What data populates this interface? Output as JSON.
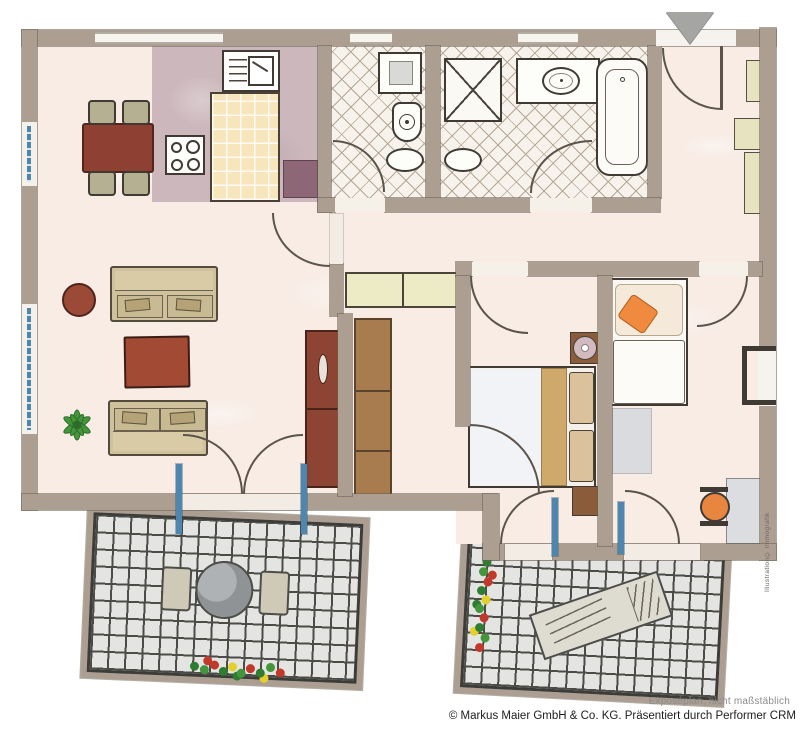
{
  "footer": {
    "disclaimer": "Exposéplan, nicht maßstäblich",
    "copyright": "© Markus Maier GmbH & Co. KG. Präsentiert durch Performer CRM"
  },
  "watermark": "Illustration© immografik",
  "plan": {
    "type": "apartment-floorplan",
    "rooms": [
      "kitchen-dining",
      "living-room",
      "guest-bathroom",
      "bathroom",
      "hallway",
      "entrance",
      "bedroom",
      "kids-room",
      "balcony-left",
      "balcony-right"
    ],
    "entrance_marker": "triangle-down"
  },
  "colors": {
    "wall": "#ac9f91",
    "floor": "#f8ece5",
    "kitchen_floor": "#ccb8bc",
    "tile_bg": "#f7f3ec",
    "tile_line": "#b3a694",
    "island": "#f7e5bb",
    "fridge": "#8d6775",
    "table_red": "#8e4133",
    "chair_olive": "#b6b093",
    "sofa_tan": "#cfc19b",
    "coffee_red": "#a34a35",
    "cabinet_red": "#8e4433",
    "wardrobe_brown": "#a87c4e",
    "shelf_beige": "#ecebc6",
    "bed_white": "#f1f3f6",
    "runner_tan": "#cfa96b",
    "pillow_tan": "#dbc29c",
    "nightstand_brown": "#8a5c3a",
    "kids_pillow": "#ef8a3e",
    "rug_gray": "#d9dbde",
    "desk_gray": "#dbdde0",
    "chair_orange": "#e8853f",
    "balcony_tile": "#e4e5e3",
    "balcony_line": "#4b4b47",
    "fence": "#3c3c38",
    "window_blue": "#4f86ad",
    "line_dark": "#3f3a33",
    "arc": "#5b544a",
    "marker_gray": "#a5a5a3",
    "text_gray": "#8c8c8c",
    "text_dark": "#1d1d1d"
  }
}
